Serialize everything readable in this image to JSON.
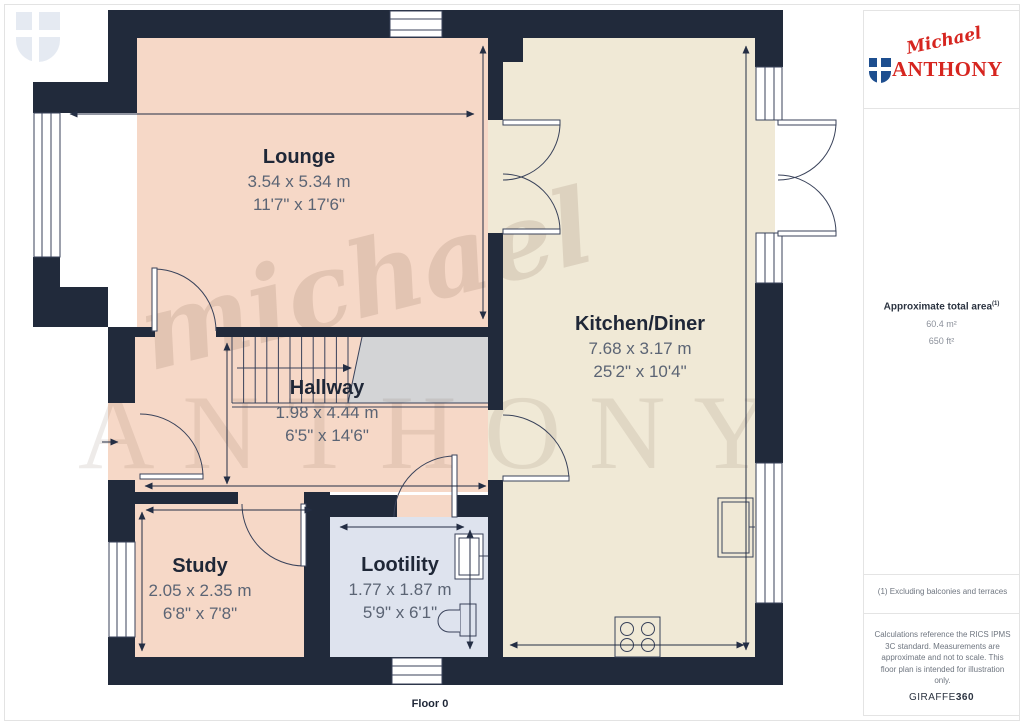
{
  "floor_label": "Floor 0",
  "watermark": {
    "script": "michael",
    "caps": "ANTHONY"
  },
  "logo": {
    "script": "Michael",
    "caps": "ANTHONY"
  },
  "rooms": [
    {
      "name": "Lounge",
      "metric": "3.54 x 5.34 m",
      "imperial": "11'7\" x 17'6\""
    },
    {
      "name": "Kitchen/Diner",
      "metric": "7.68 x 3.17 m",
      "imperial": "25'2\" x 10'4\""
    },
    {
      "name": "Hallway",
      "metric": "1.98 x 4.44 m",
      "imperial": "6'5\" x 14'6\""
    },
    {
      "name": "Study",
      "metric": "2.05 x 2.35 m",
      "imperial": "6'8\" x 7'8\""
    },
    {
      "name": "Lootility",
      "metric": "1.77 x 1.87 m",
      "imperial": "5'9\" x 6'1\""
    }
  ],
  "sidebar": {
    "area_title": "Approximate total area",
    "area_sup": "(1)",
    "area_m2": "60.4 m²",
    "area_ft2": "650 ft²",
    "footnote": "(1) Excluding balconies and terraces",
    "disclaimer": "Calculations reference the RICS IPMS 3C standard. Measurements are approximate and not to scale. This floor plan is intended for illustration only.",
    "brand_regular": "GIRAFFE",
    "brand_bold": "360"
  },
  "colors": {
    "wall": "#212a3b",
    "lounge_fill": "#f6d8c7",
    "kitchen_fill": "#f0e9d6",
    "utility_fill": "#dee3ee",
    "stairs_fill": "#d3d4d6",
    "linework": "#39425a",
    "brand_red": "#d6251f",
    "brand_blue": "#1d4e8f"
  }
}
